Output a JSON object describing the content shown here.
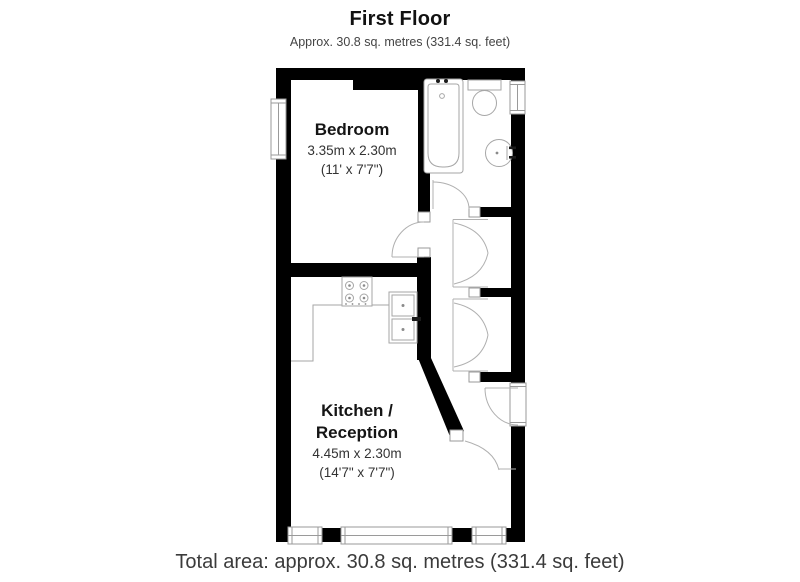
{
  "header": {
    "title": "First Floor",
    "subtitle": "Approx. 30.8 sq. metres (331.4 sq. feet)"
  },
  "rooms": {
    "bedroom": {
      "name": "Bedroom",
      "dimensions_metric": "3.35m x 2.30m",
      "dimensions_imperial": "(11' x 7'7\")"
    },
    "kitchen_reception": {
      "name_line1": "Kitchen /",
      "name_line2": "Reception",
      "dimensions_metric": "4.45m x 2.30m",
      "dimensions_imperial": "(14'7\" x 7'7\")"
    }
  },
  "footer": {
    "total_area": "Total area: approx. 30.8 sq. metres (331.4 sq. feet)"
  },
  "colors": {
    "wall": "#000000",
    "fixture_line": "#a6a6a6",
    "text": "#222222"
  }
}
